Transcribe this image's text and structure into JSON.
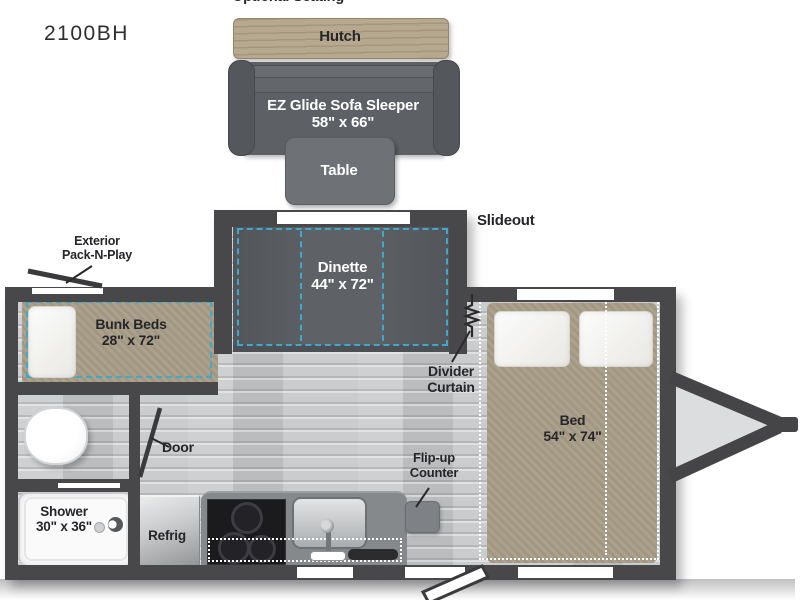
{
  "model": "2100BH",
  "top_labels": {
    "optional_seating": "Optional Seating",
    "slideout": "Slideout"
  },
  "furniture": {
    "hutch": {
      "label": "Hutch"
    },
    "sofa": {
      "name": "EZ Glide Sofa Sleeper",
      "size": "58\" x 66\""
    },
    "table": {
      "label": "Table"
    },
    "dinette": {
      "name": "Dinette",
      "size": "44\" x 72\""
    },
    "bunk_beds": {
      "name": "Bunk Beds",
      "size": "28\" x 72\""
    },
    "bed": {
      "name": "Bed",
      "size": "54\" x 74\""
    },
    "shower": {
      "name": "Shower",
      "size": "30\" x 36\""
    },
    "refrigerator": {
      "label": "Refrig"
    }
  },
  "annotations": {
    "exterior_pack_n_play": {
      "line1": "Exterior",
      "line2": "Pack-N-Play"
    },
    "divider_curtain": {
      "line1": "Divider",
      "line2": "Curtain"
    },
    "door": {
      "label": "Door"
    },
    "flip_up_counter": {
      "line1": "Flip-up",
      "line2": "Counter"
    }
  },
  "colors": {
    "wall": "#48474a",
    "floor": "#c6c8ca",
    "mattress_tan": "#a79c86",
    "hutch_wood": "#b7a98f",
    "accent_dash": "#3fa9cc",
    "sofa_gray": "#5d6165",
    "counter_gray": "#86898c",
    "stove_black": "#1b1b1e"
  }
}
